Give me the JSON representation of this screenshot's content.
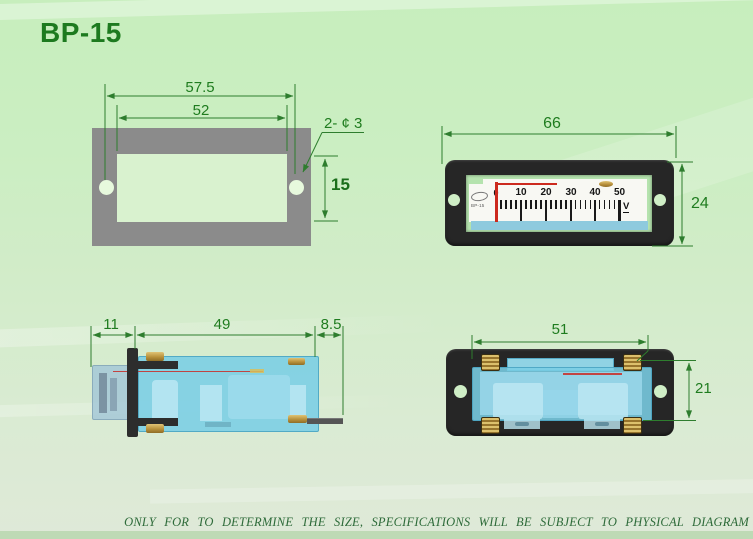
{
  "title": "BP-15",
  "footer_note": "ONLY FOR TO DETERMINE THE SIZE, SPECIFICATIONS WILL BE SUBJECT TO PHYSICAL DIAGRAM",
  "colors": {
    "dimension_green": "#2e7d2e",
    "label_green": "#1f7c1f",
    "panel_gray": "#8b8b8b",
    "frame_black": "#262626",
    "body_cyan": "#7aceE5",
    "pointer_red": "#cc2a1e",
    "dial_blue_strip": "#8ecade",
    "brass": "#c2a050",
    "background_green": "#cdeec4"
  },
  "views": {
    "panel_cutout": {
      "dim_hole_spacing": "57.5",
      "dim_cutout_width": "52",
      "dim_holes": "2- ¢ 3",
      "dim_cutout_height": "15"
    },
    "meter_front": {
      "dim_width": "66",
      "dim_height": "24",
      "dial": {
        "zero": "0",
        "labels": [
          "10",
          "20",
          "30",
          "40",
          "50"
        ],
        "unit": "V",
        "brand": "BP-15"
      }
    },
    "meter_side": {
      "dim_front_depth": "11",
      "dim_body_length": "49",
      "dim_terminal_length": "8.5"
    },
    "meter_rear": {
      "dim_width": "51",
      "dim_height": "21"
    }
  }
}
